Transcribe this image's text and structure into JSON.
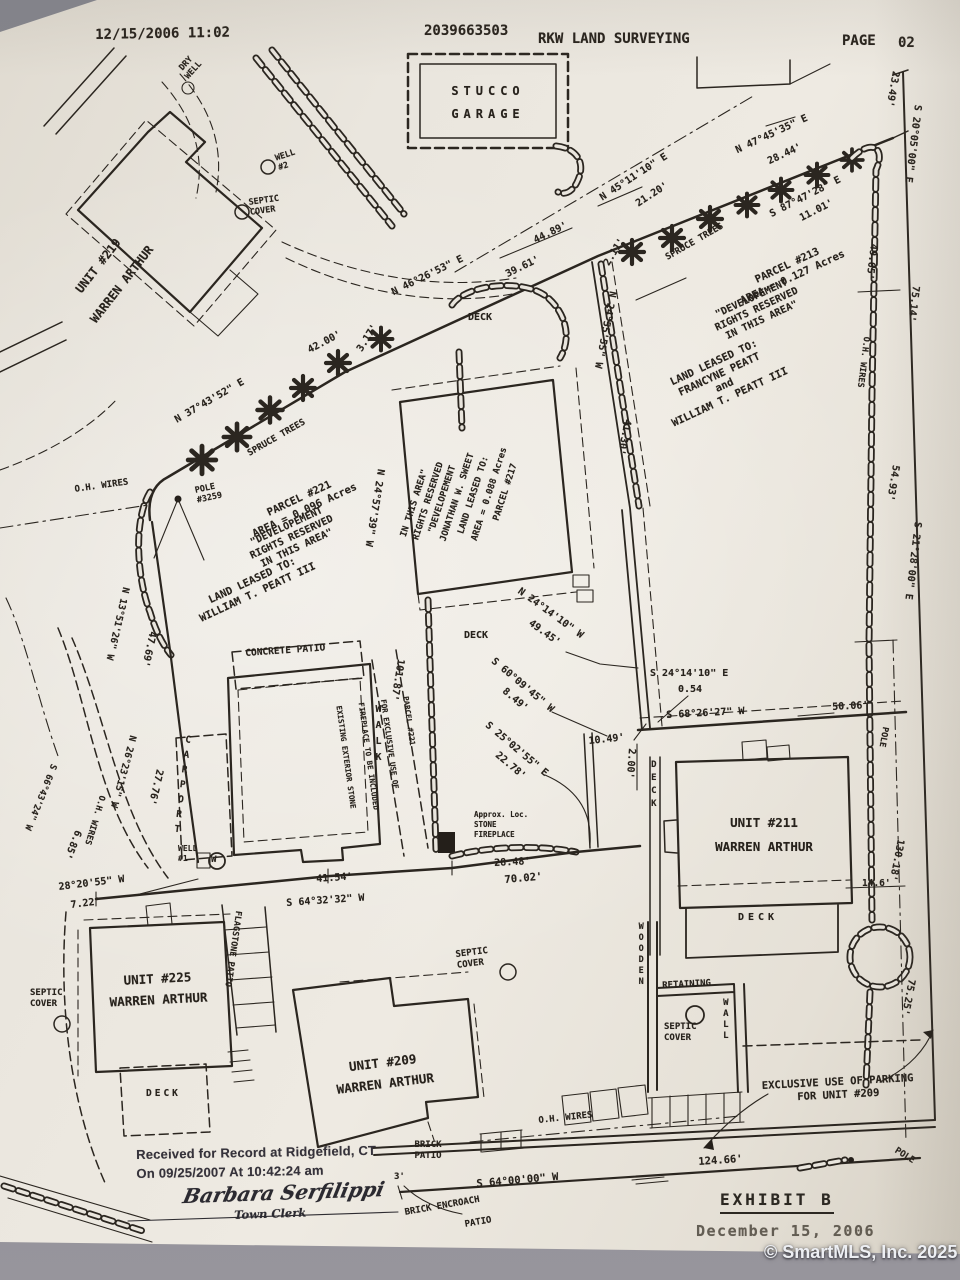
{
  "header": {
    "fax_datetime": "12/15/2006 11:02",
    "fax_number": "2039663503",
    "sender": "RKW LAND SURVEYING",
    "page_label": "PAGE",
    "page_number": "02"
  },
  "parcels": {
    "p213": {
      "title": "PARCEL #213\nAREA = 0.127 Acres",
      "note": "\"DEVELOPEMENT\nRIGHTS RESERVED\nIN THIS AREA\"",
      "leased": "LAND LEASED TO:\nFRANCYNE PEATT\nand\nWILLIAM T. PEATT III"
    },
    "p221": {
      "title": "PARCEL #221\nAREA = 0.096 Acres",
      "note": "\"DEVELOPEMENT\nRIGHTS RESERVED\nIN THIS AREA\"",
      "leased": "LAND LEASED TO:\nWILLIAM T. PEATT III"
    },
    "p217": {
      "l1": "PARCEL #217",
      "l2": "AREA = 0.088 Acres",
      "l3": "LAND LEASED TO:",
      "l4": "JONATHAN W. SWEET",
      "l5": "\"DEVELOPEMENT",
      "l6": "RIGHTS RESERVED",
      "l7": "IN THIS AREA\""
    }
  },
  "units": {
    "u219": "UNIT #219\nWARREN ARTHUR",
    "u211": "UNIT #211\nWARREN ARTHUR",
    "u225": "UNIT #225\nWARREN ARTHUR",
    "u209": "UNIT #209\nWARREN ARTHUR"
  },
  "bearings": {
    "n45": "N 45°11'10\" E",
    "d2120": "21.20'",
    "n47": "N 47°45'35\" E",
    "d2844": "28.44'",
    "s87": "S 87°47'28\" E",
    "d1101": "11.01'",
    "d2349": "23.49'",
    "s20": "S 20°05'00\" E",
    "d4965": "49.65'",
    "d7514": "75.14'",
    "d5493": "54.93'",
    "s21": "S 21°28'00\" E",
    "d5006": "50.06'",
    "d13018": "130.18'",
    "d146": "14.6'",
    "d7525": "75.25'",
    "n46": "N 46°26'53\" E",
    "d3961": "39.61'",
    "d4489": "44.89'",
    "d4200": "42.00'",
    "n37": "N 37°43'52\" E",
    "d317": "3.17'",
    "d211": "2.11'",
    "n2455": "N 24°55'55\" W",
    "d4130": "41.30'",
    "n2457": "N 24°57'39\" W",
    "d10187": "101.87'",
    "n2414": "N 24°14'10\" W",
    "d4945": "49.45'",
    "s2414": "S 24°14'10\" E",
    "d054": "0.54",
    "s68": "S 68°26'27\" W",
    "s60": "S 60°09'45\" W",
    "d849": "8.49'",
    "s25": "S 25°02'55\" E",
    "d2278": "22.78'",
    "d1049": "10.49'",
    "d200": "2.00'",
    "n13": "N 13°51'26\" W",
    "d4769": "47.69'",
    "d2776": "27.76'",
    "n26": "N 26°23'15\" W",
    "s66": "S 66°43'24\" W",
    "d685": "6.85'",
    "d2820": "28°20'55\" W",
    "d722": "7.22'",
    "d4154": "41.54'",
    "s6432": "S 64°32'32\" W",
    "d7002": "70.02'",
    "d2848": "28.48'",
    "s6400": "S 64°00'00\" W",
    "d12466": "124.66'",
    "d3": "3'"
  },
  "features": {
    "dry_well": "DRY\nWELL",
    "well2": "WELL\n#2",
    "well1": "WELL\n#1",
    "well_symbol": "W",
    "septic": "SEPTIC\nCOVER",
    "oh_wires": "O.H. WIRES",
    "spruce": "SPRUCE TREES",
    "pole": "POLE",
    "pole3259": "POLE\n#3259",
    "deck": "DECK",
    "walk": "WALK",
    "carport": "CARPORT",
    "concrete_patio": "CONCRETE PATIO",
    "flagstone": "FLAGSTONE PATIO",
    "wooden": "WOODEN",
    "retaining": "RETAINING",
    "wall": "WALL",
    "stucco_garage": "STUCCO\nGARAGE",
    "brick_patio": "BRICK\nPATIO",
    "brick_encroach": "BRICK ENCROACH",
    "patio": "PATIO",
    "stone_fireplace": "Approx. Loc.\nSTONE\nFIREPLACE",
    "exclusive_parking": "EXCLUSIVE USE OF PARKING\nFOR UNIT #209"
  },
  "fireplace_note": {
    "l1": "EXISTING EXTERIOR STONE",
    "l2": "FIREPLACE TO BE INCLUDED",
    "l3": "FOR EXCLUSIVE USE OF",
    "l4": "PARCEL #221"
  },
  "footer": {
    "received": "Received for Record at Ridgefield, CT\nOn 09/25/2007 At 10:42:24 am",
    "signature": "Barbara Serfilippi",
    "signature_title": "Town Clerk",
    "exhibit_title": "EXHIBIT B",
    "exhibit_date": "December 15, 2006"
  },
  "watermark": "© SmartMLS, Inc. 2025"
}
